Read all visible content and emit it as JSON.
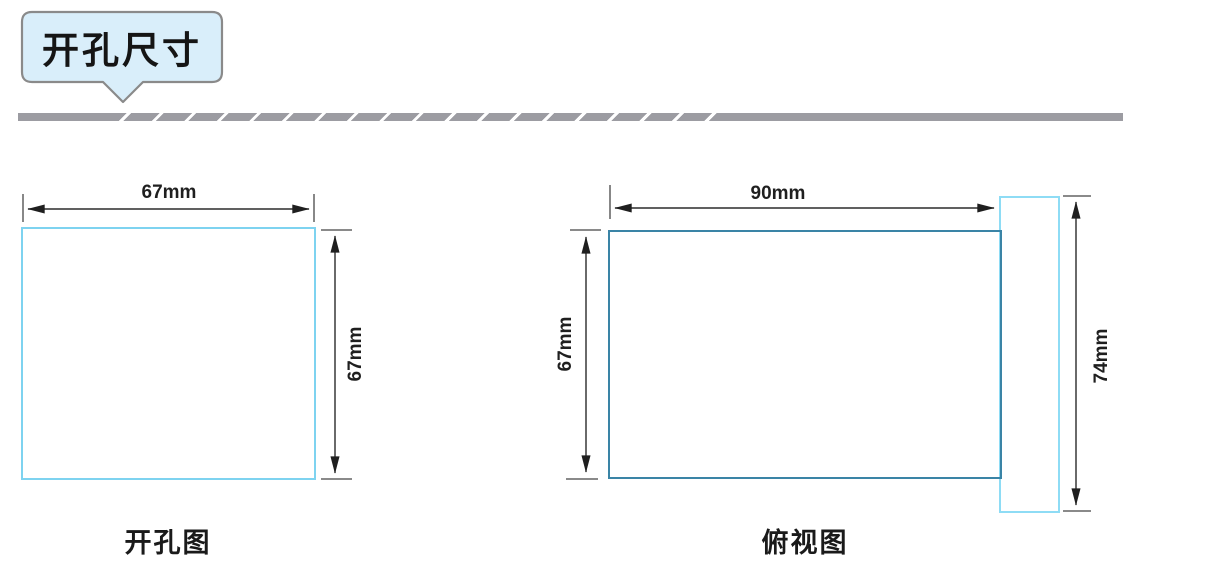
{
  "header": {
    "title": "开孔尺寸"
  },
  "diagrams": {
    "cutout": {
      "caption": "开孔图",
      "width": "67mm",
      "height": "67mm"
    },
    "top_view": {
      "caption": "俯视图",
      "width": "90mm",
      "inner_height": "67mm",
      "outer_height": "74mm"
    }
  },
  "colors": {
    "badge_fill": "#d9eefa",
    "badge_border": "#8a8a8a",
    "divider_gray": "#9c9ca2",
    "cutout_outline": "#7ed3f0",
    "panel_outline": "#3a84a6",
    "bezel_outline": "#8edcf5",
    "dimension_line": "#2b2b2b",
    "extension_tick": "#7a7a7a",
    "text": "#1a1a1a"
  }
}
